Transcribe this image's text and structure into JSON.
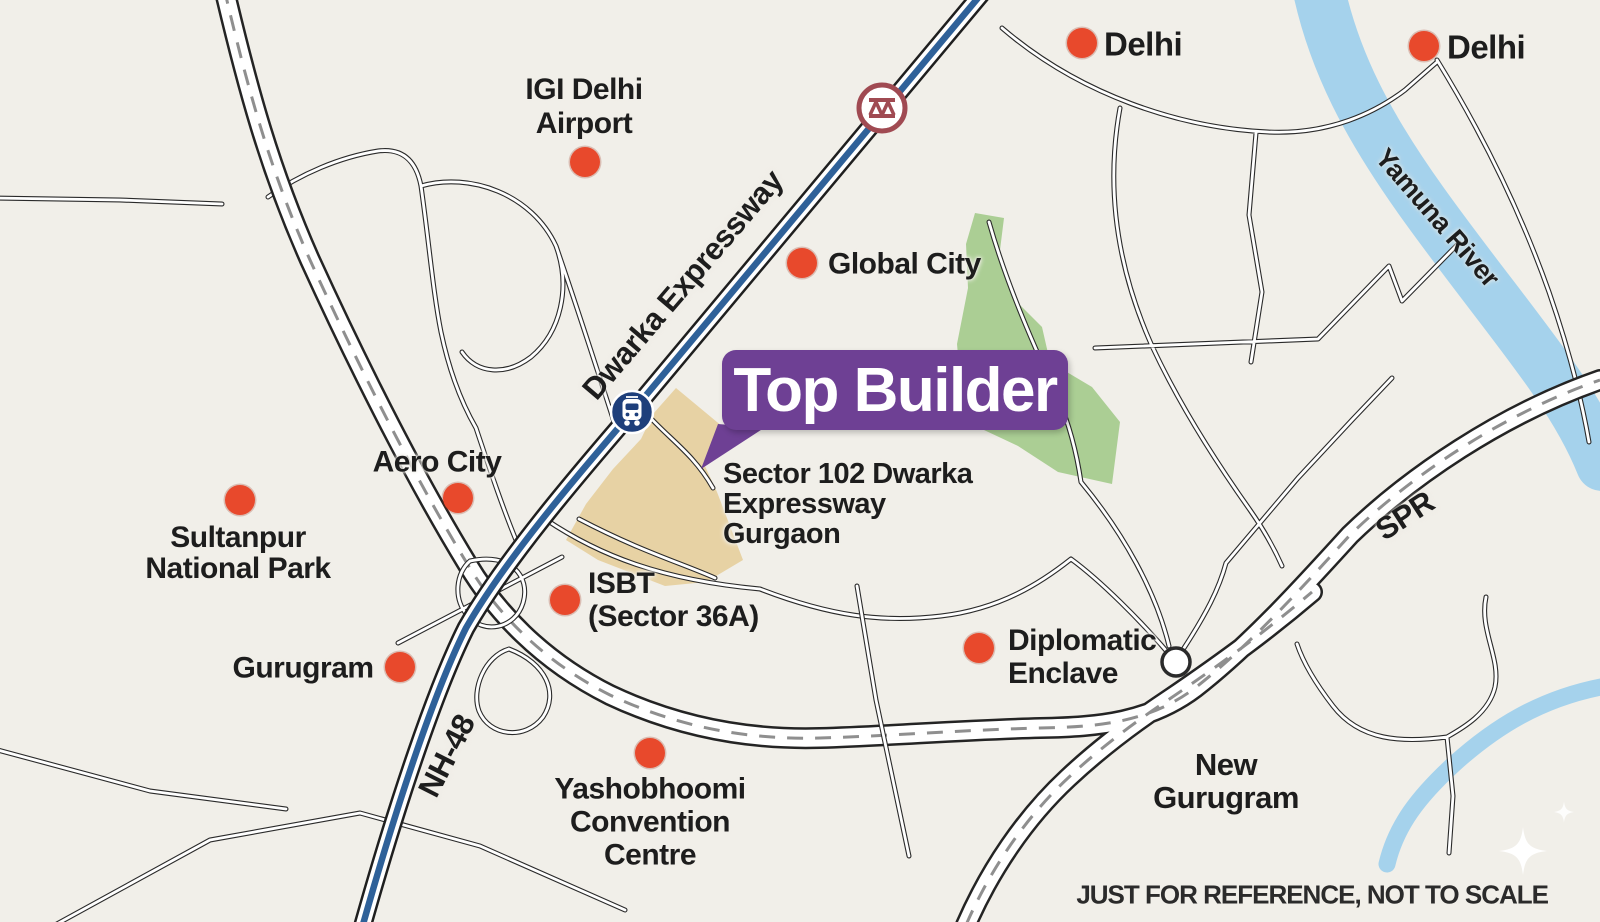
{
  "banner": {
    "label": "Top Builder"
  },
  "disclaimer": "JUST FOR REFERENCE, NOT TO SCALE",
  "colors": {
    "background": "#f1efe9",
    "marker_red": "#e8492c",
    "accent_purple": "#6e4094",
    "water_blue": "#a5d2ec",
    "park_green": "#abce94",
    "site_tan": "#e7d2a4",
    "expressway_blue": "#2f6199",
    "road_black": "#2a2a2a"
  },
  "icons": {
    "location_marker": "red-dot",
    "metro_station": "train-front-in-navy-circle",
    "delhi_metro_logo": "maroon-ring-with-zigzag-m",
    "roundabout": "small-white-circle",
    "sparkle": "four-point-star"
  },
  "locations": [
    {
      "id": "delhi-west",
      "lines": [
        "Delhi"
      ],
      "dot": [
        1082,
        43
      ],
      "label": {
        "x": 1104,
        "y": 44,
        "align": "left",
        "size": 33
      }
    },
    {
      "id": "delhi-east",
      "lines": [
        "Delhi"
      ],
      "dot": [
        1424,
        46
      ],
      "label": {
        "x": 1447,
        "y": 47,
        "align": "left",
        "size": 33
      }
    },
    {
      "id": "igi-delhi-airport",
      "lines": [
        "IGI Delhi",
        "Airport"
      ],
      "dot": [
        585,
        162
      ],
      "label": {
        "x": 584,
        "y": 107,
        "align": "center",
        "size": 30,
        "lh": 34
      }
    },
    {
      "id": "global-city",
      "lines": [
        "Global City"
      ],
      "dot": [
        802,
        263
      ],
      "label": {
        "x": 828,
        "y": 264,
        "align": "left",
        "size": 30
      }
    },
    {
      "id": "aero-city",
      "lines": [
        "Aero City"
      ],
      "dot": [
        458,
        498
      ],
      "label": {
        "x": 437,
        "y": 462,
        "align": "center",
        "size": 30
      }
    },
    {
      "id": "sultanpur-national-park",
      "lines": [
        "Sultanpur",
        "National Park"
      ],
      "dot": [
        240,
        500
      ],
      "label": {
        "x": 238,
        "y": 553,
        "align": "center",
        "size": 30
      }
    },
    {
      "id": "gurugram",
      "lines": [
        "Gurugram"
      ],
      "dot": [
        400,
        667
      ],
      "label": {
        "x": 303,
        "y": 668,
        "align": "center",
        "size": 30
      }
    },
    {
      "id": "isbt-sector-36a",
      "lines": [
        "ISBT",
        "(Sector 36A)"
      ],
      "dot": [
        565,
        600
      ],
      "label": {
        "x": 588,
        "y": 600,
        "align": "left",
        "size": 30,
        "lh": 33
      }
    },
    {
      "id": "yashobhoomi-convention-centre",
      "lines": [
        "Yashobhoomi",
        "Convention",
        "Centre"
      ],
      "dot": [
        650,
        753
      ],
      "label": {
        "x": 650,
        "y": 822,
        "align": "center",
        "size": 30,
        "lh": 33
      }
    },
    {
      "id": "diplomatic-enclave",
      "lines": [
        "Diplomatic",
        "Enclave"
      ],
      "dot": [
        979,
        648
      ],
      "label": {
        "x": 1008,
        "y": 657,
        "align": "left",
        "size": 30,
        "lh": 33
      }
    }
  ],
  "area_labels": [
    {
      "id": "site-address",
      "lines": [
        "Sector 102 Dwarka",
        "Expressway",
        "Gurgaon"
      ],
      "x": 723,
      "y": 504,
      "align": "left",
      "size": 29,
      "lh": 30
    },
    {
      "id": "new-gurugram",
      "lines": [
        "New",
        "Gurugram"
      ],
      "x": 1226,
      "y": 781,
      "align": "center",
      "size": 31,
      "lh": 33
    }
  ],
  "road_labels": [
    {
      "id": "dwarka-expressway",
      "text": "Dwarka Expressway",
      "x": 683,
      "y": 285,
      "rotate": -49.5,
      "size": 31
    },
    {
      "id": "nh-48",
      "text": "NH-48",
      "x": 447,
      "y": 756,
      "rotate": -63,
      "size": 31
    },
    {
      "id": "spr",
      "text": "SPR",
      "x": 1405,
      "y": 516,
      "rotate": -33,
      "size": 31
    },
    {
      "id": "yamuna-river",
      "text": "Yamuna River",
      "x": 1437,
      "y": 218,
      "rotate": 49,
      "size": 27
    }
  ]
}
